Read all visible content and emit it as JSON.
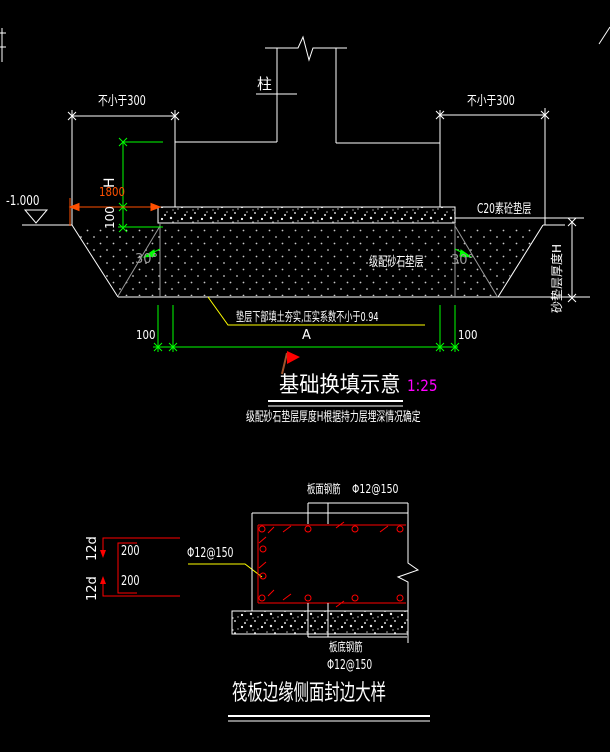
{
  "colors": {
    "background": "#000000",
    "line_white": "#ffffff",
    "dim_green": "#00ff00",
    "dim_orange": "#ff5000",
    "leader_yellow": "#ffff00",
    "rebar_red": "#ff0000",
    "scale_magenta": "#ff00ff",
    "slope_gray": "#9a9a9a",
    "flag_pole_brown": "#a0522d"
  },
  "top_detail": {
    "title": "基础换填示意",
    "scale": "1:25",
    "note": "级配砂石垫层厚度H根据持力层埋深情况确定",
    "column_label": "柱",
    "elevation_label": "-1.000",
    "min_width_left": "不小于300",
    "min_width_right": "不小于300",
    "depth_h_label": "H",
    "width_1800": "1800",
    "cushion_thickness_100": "100",
    "c20_cushion_label": "C20素砼垫层",
    "graded_gravel_label": "级配砂石垫层",
    "slope_angle_left": "30°",
    "slope_angle_right": "30°",
    "sand_cushion_depth_label": "砂垫层厚度H",
    "compaction_note": "垫层下部填土夯实,压实系数不小于0.94",
    "overhang_left_100": "100",
    "width_a": "A",
    "overhang_right_100": "100"
  },
  "bottom_detail": {
    "title": "筏板边缘侧面封边大样",
    "hook_length_top": "12d",
    "hook_length_bottom": "12d",
    "spacing_top_200": "200",
    "spacing_bottom_200": "200",
    "edge_bar_spec": "Φ12@150",
    "top_bar_label": "板面钢筋",
    "top_bar_spec": "Φ12@150",
    "bottom_bar_label": "板底钢筋",
    "bottom_bar_spec": "Φ12@150"
  }
}
